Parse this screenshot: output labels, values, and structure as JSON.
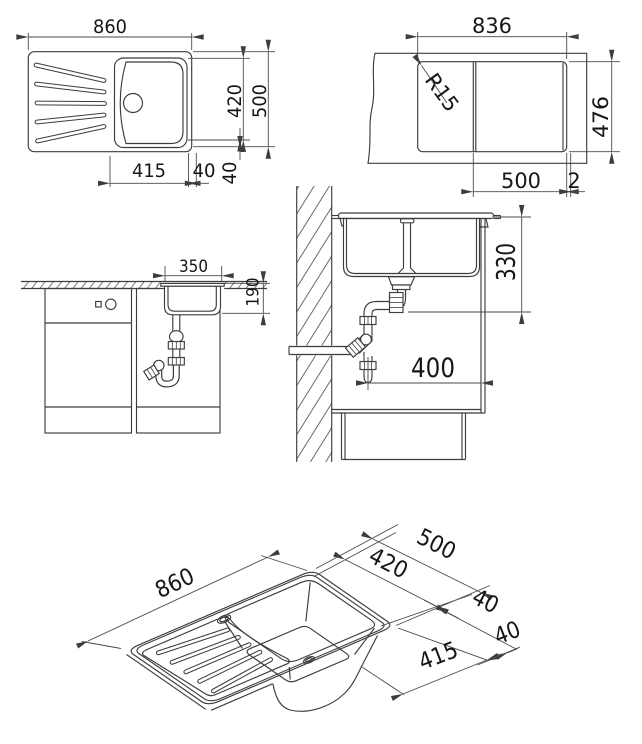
{
  "drawing": {
    "type": "kitchen sink technical installation drawing",
    "colors": {
      "background": "#ffffff",
      "line": "#3d3d3d",
      "dim": "#4a4a4a"
    },
    "plan_view": {
      "overall_width": "860",
      "bowl_depth": "420",
      "overall_depth": "500",
      "bowl_width": "415",
      "rim_right": "40",
      "rim_bottom": "40"
    },
    "cutout_view": {
      "cutout_width": "836",
      "corner_radius": "R15",
      "cutout_depth": "476",
      "bowl_zone_width": "500",
      "edge_gap": "2"
    },
    "front_view": {
      "bowl_inner_width": "350",
      "bowl_inner_depth": "190"
    },
    "side_view": {
      "installation_depth": "330",
      "siphon_clearance": "400"
    },
    "iso_view": {
      "overall_width": "860",
      "overall_depth": "500",
      "bowl_depth": "420",
      "rim_depth_gap": "40",
      "rim_width_gap": "40",
      "bowl_width": "415"
    }
  }
}
